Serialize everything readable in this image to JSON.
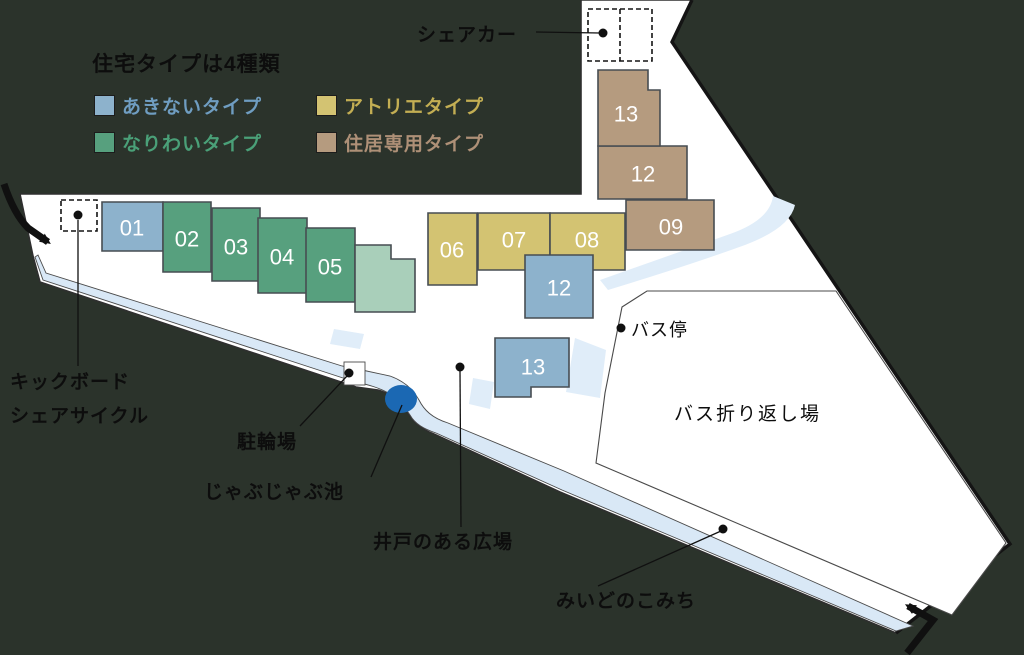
{
  "title": "住宅タイプは4種類",
  "legend": [
    {
      "label": "あきないタイプ",
      "type": "akinai",
      "swatch_color": "#8db2cc",
      "text_color": "#6f9dc1"
    },
    {
      "label": "アトリエタイプ",
      "type": "atelier",
      "swatch_color": "#d3c372",
      "text_color": "#c3ae53"
    },
    {
      "label": "なりわいタイプ",
      "type": "nariwai",
      "swatch_color": "#57a07e",
      "text_color": "#4aa078"
    },
    {
      "label": "住居専用タイプ",
      "type": "jukyo",
      "swatch_color": "#b59b7f",
      "text_color": "#ae9077"
    }
  ],
  "map_labels": {
    "share_car": "シェアカー",
    "kickboard_line1": "キックボード",
    "kickboard_line2": "シェアサイクル",
    "bicycle_parking": "駐輪場",
    "pond": "じゃぶじゃぶ池",
    "well_plaza": "井戸のある広場",
    "bus_stop": "バス停",
    "bus_turnaround": "バス折り返し場",
    "komichi": "みいどのこみち"
  },
  "buildings": [
    {
      "number": "01",
      "type": "akinai",
      "shape": "102,202 163,202 163,251 102,251",
      "label_x": 132,
      "label_y": 228
    },
    {
      "number": "02",
      "type": "nariwai",
      "shape": "163,202 211,202 211,272 163,272",
      "label_x": 187,
      "label_y": 239
    },
    {
      "number": "03",
      "type": "nariwai",
      "shape": "212,208 260,208 260,281 212,281",
      "label_x": 236,
      "label_y": 247
    },
    {
      "number": "04",
      "type": "nariwai",
      "shape": "258,218 307,218 307,293 258,293",
      "label_x": 282,
      "label_y": 257
    },
    {
      "number": "05",
      "type": "nariwai",
      "shape": "306,228 355,228 355,302 306,302",
      "label_x": 330,
      "label_y": 267
    },
    {
      "number": "",
      "type": "mint",
      "shape": "355,245 391,245 391,259 415,259 415,312 355,312",
      "label_x": 385,
      "label_y": 280
    },
    {
      "number": "06",
      "type": "atelier",
      "shape": "428,213 477,213 477,285 428,285",
      "label_x": 452,
      "label_y": 250
    },
    {
      "number": "07",
      "type": "atelier",
      "shape": "478,213 550,213 550,270 478,270",
      "label_x": 514,
      "label_y": 240
    },
    {
      "number": "08",
      "type": "atelier",
      "shape": "550,213 625,213 625,270 550,270",
      "label_x": 587,
      "label_y": 240
    },
    {
      "number": "09",
      "type": "jukyo",
      "shape": "626,200 714,200 714,250 626,250",
      "label_x": 671,
      "label_y": 227
    },
    {
      "number": "12",
      "type": "jukyo",
      "shape": "598,146 687,146 687,199 598,199",
      "label_x": 643,
      "label_y": 174
    },
    {
      "number": "13",
      "type": "jukyo",
      "shape": "598,70 648,70 648,90 660,90 660,146 598,146",
      "label_x": 626,
      "label_y": 114
    },
    {
      "number": "12",
      "type": "akinai",
      "shape": "525,255 593,255 593,318 525,318",
      "label_x": 559,
      "label_y": 288
    },
    {
      "number": "13",
      "type": "akinai",
      "shape": "495,338 569,338 569,387 531,387 531,397 495,397",
      "label_x": 533,
      "label_y": 367
    }
  ],
  "colors": {
    "akinai": "#8db2cc",
    "nariwai": "#57a07e",
    "atelier": "#d3c372",
    "jukyo": "#b59b7f",
    "mint": "#a9cfba",
    "building_stroke": "#474d52",
    "pond": "#1b68b3",
    "road": "#d9e8f6",
    "path_patch": "#e0edf9",
    "site": "#ffffff",
    "background": "#2b332b",
    "number_text": "#ffffff"
  }
}
